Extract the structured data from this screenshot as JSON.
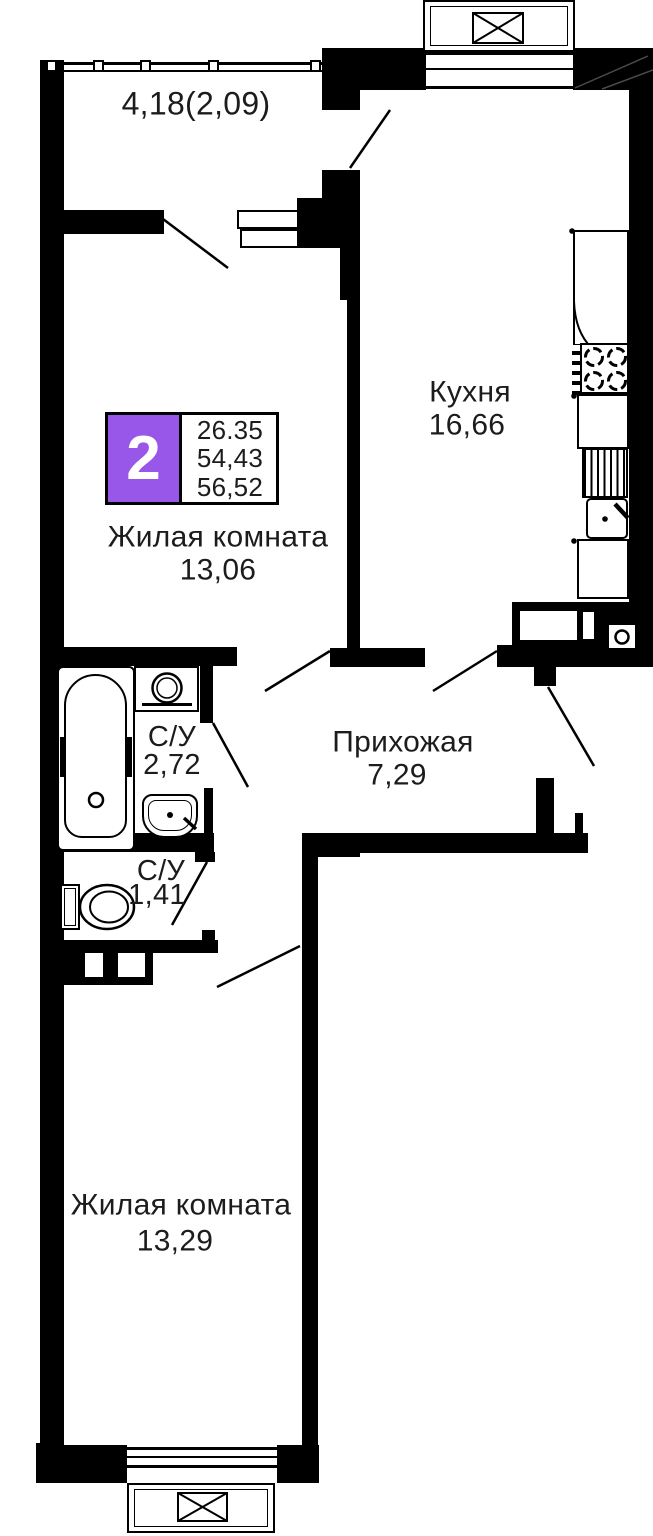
{
  "plan": {
    "title": "2-room apartment floor plan",
    "unit_badge": {
      "number": "2",
      "values": [
        "26.35",
        "54,43",
        "56,52"
      ]
    },
    "rooms": {
      "balcony": {
        "dim": "4,18(2,09)"
      },
      "kitchen": {
        "name": "Кухня",
        "area": "16,66"
      },
      "living1": {
        "name": "Жилая комната",
        "area": "13,06"
      },
      "hallway": {
        "name": "Прихожая",
        "area": "7,29"
      },
      "bath1": {
        "name": "С/У",
        "area": "2,72"
      },
      "bath2": {
        "name": "С/У",
        "area": "1,41"
      },
      "living2": {
        "name": "Жилая комната",
        "area": "13,29"
      }
    },
    "colors": {
      "accent": "#9857e8",
      "wall": "#000000",
      "text": "#1c1c1c"
    }
  }
}
